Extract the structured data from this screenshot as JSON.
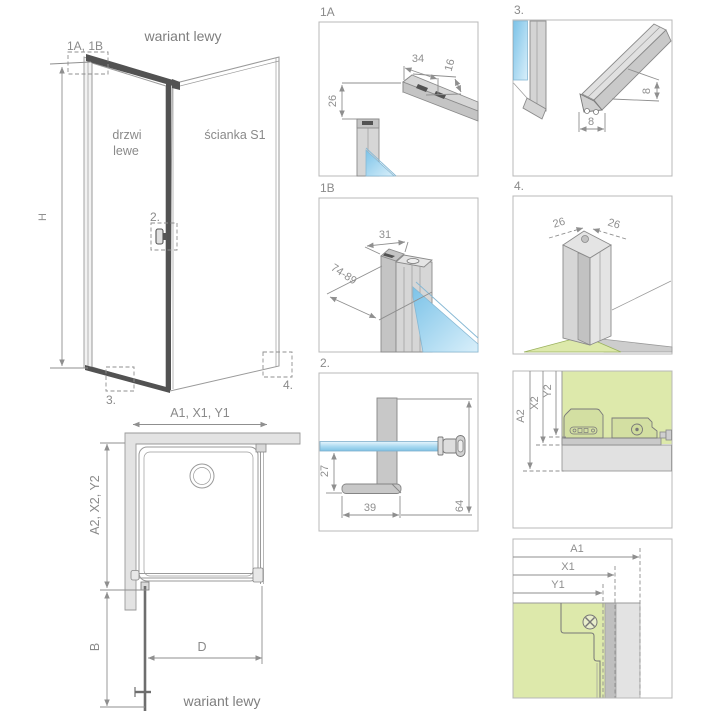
{
  "titles": {
    "top": "wariant lewy",
    "bottom": "wariant lewy"
  },
  "iso": {
    "ref_top": "1A, 1B",
    "ref_handle": "2.",
    "ref_bottom": "3.",
    "ref_wall": "4.",
    "dim_height": "H",
    "door_line1": "drzwi",
    "door_line2": "lewe",
    "wall_label": "ścianka S1"
  },
  "plan": {
    "dim_top": "A1, X1, Y1",
    "dim_left": "A2, X2, Y2",
    "dim_b": "B",
    "dim_d": "D"
  },
  "boxes": {
    "b1a": {
      "label": "1A",
      "dim_width": "34",
      "dim_height": "16",
      "dim_depth": "26"
    },
    "b1b": {
      "label": "1B",
      "dim_width": "31",
      "dim_range": "74-89"
    },
    "b2": {
      "label": "2.",
      "dim_offset": "27",
      "dim_foot": "39",
      "dim_height": "64"
    },
    "b3": {
      "label": "3.",
      "dim_w": "8",
      "dim_h": "8"
    },
    "b4": {
      "label": "4.",
      "dim_left": "26",
      "dim_right": "26"
    },
    "b5": {
      "dim_a2": "A2",
      "dim_x2": "X2",
      "dim_y2": "Y2"
    },
    "b6": {
      "dim_a1": "A1",
      "dim_x1": "X1",
      "dim_y1": "Y1"
    }
  },
  "colors": {
    "glass_blue": "#a9d9ef",
    "panel_green": "#dde9ab",
    "profile_gray": "#d6d6d6",
    "accent_dark": "#525252",
    "line_gray": "#8f8f8f"
  }
}
